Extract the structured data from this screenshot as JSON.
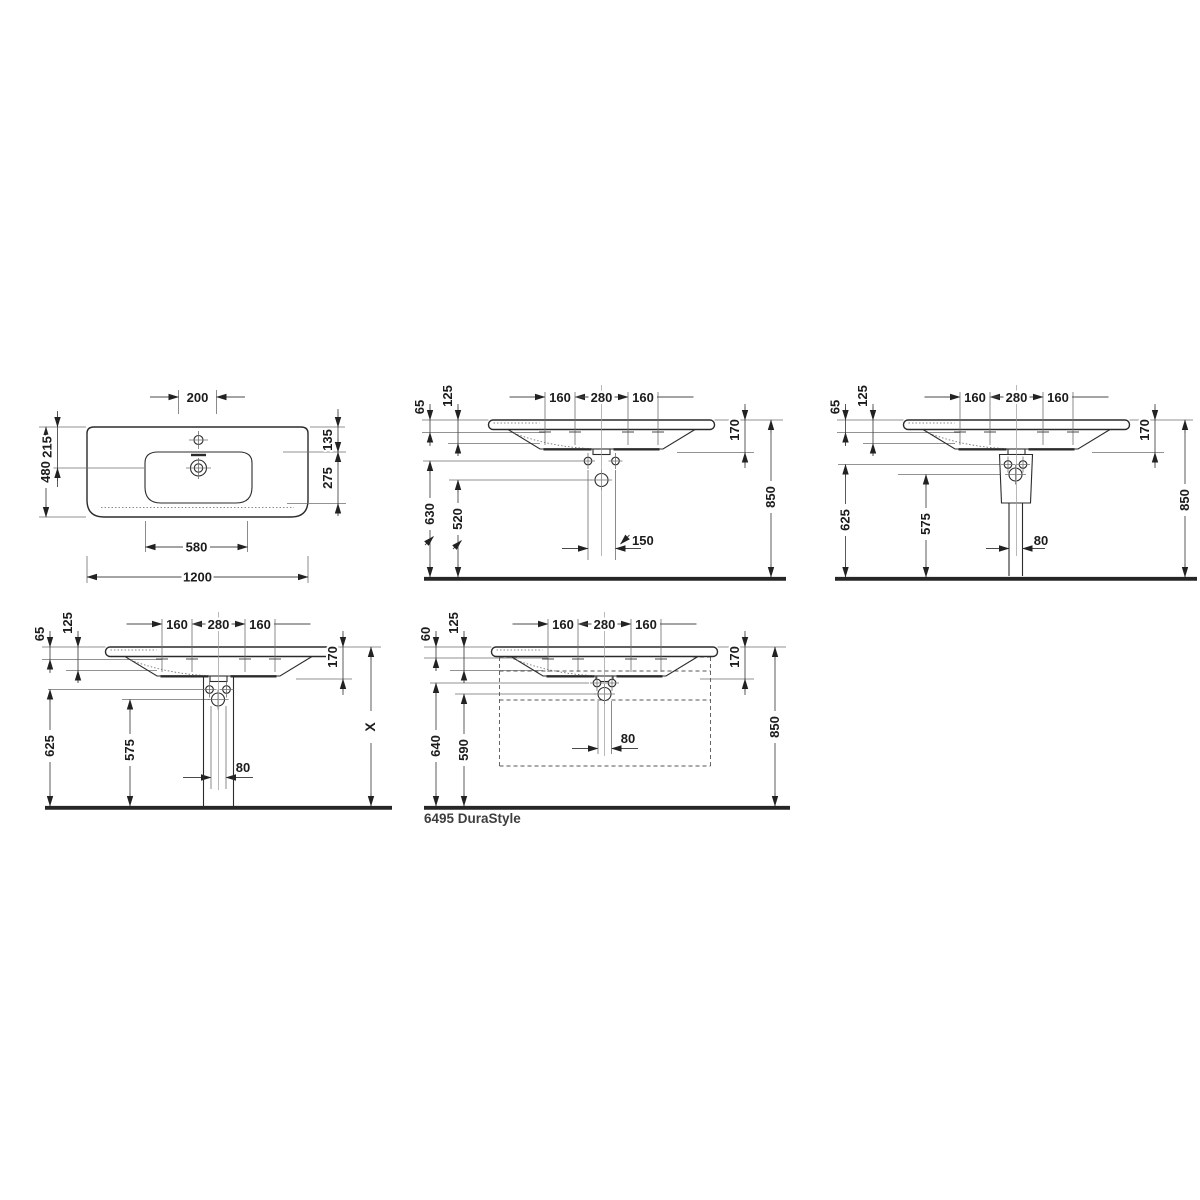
{
  "caption": {
    "label": "6495 DuraStyle"
  },
  "colors": {
    "line": "#2b2b2b",
    "dim_text": "#1c1c1c",
    "caption_text": "#3e3e3e",
    "background": "#ffffff"
  },
  "views": {
    "plan": {
      "dims": {
        "tap_center": "200",
        "overall_depth": "480",
        "back_to_drain": "215",
        "back_to_bowl": "135",
        "bowl_depth": "275",
        "bowl_width": "580",
        "overall_width": "1200"
      }
    },
    "wall_mounted": {
      "dims": {
        "rim_drop": "65",
        "front_height": "125",
        "holes_left": "160",
        "holes_center": "280",
        "holes_right": "160",
        "basin_height": "170",
        "fixing_height": "630",
        "drain_height": "520",
        "fixing_spacing": "150",
        "rim_height": "850"
      }
    },
    "semi_pedestal": {
      "dims": {
        "rim_drop": "65",
        "front_height": "125",
        "holes_left": "160",
        "holes_center": "280",
        "holes_right": "160",
        "basin_height": "170",
        "fixing_height": "625",
        "drain_height": "575",
        "outlet_width": "80",
        "rim_height": "850"
      }
    },
    "pedestal": {
      "dims": {
        "rim_drop": "65",
        "front_height": "125",
        "holes_left": "160",
        "holes_center": "280",
        "holes_right": "160",
        "basin_height": "170",
        "fixing_height": "625",
        "drain_height": "575",
        "outlet_width": "80",
        "rim_height": "X"
      }
    },
    "vanity_unit": {
      "dims": {
        "rim_drop": "60",
        "front_height": "125",
        "holes_left": "160",
        "holes_center": "280",
        "holes_right": "160",
        "basin_height": "170",
        "fixing_height": "640",
        "drain_height": "590",
        "outlet_width": "80",
        "rim_height": "850"
      }
    }
  }
}
